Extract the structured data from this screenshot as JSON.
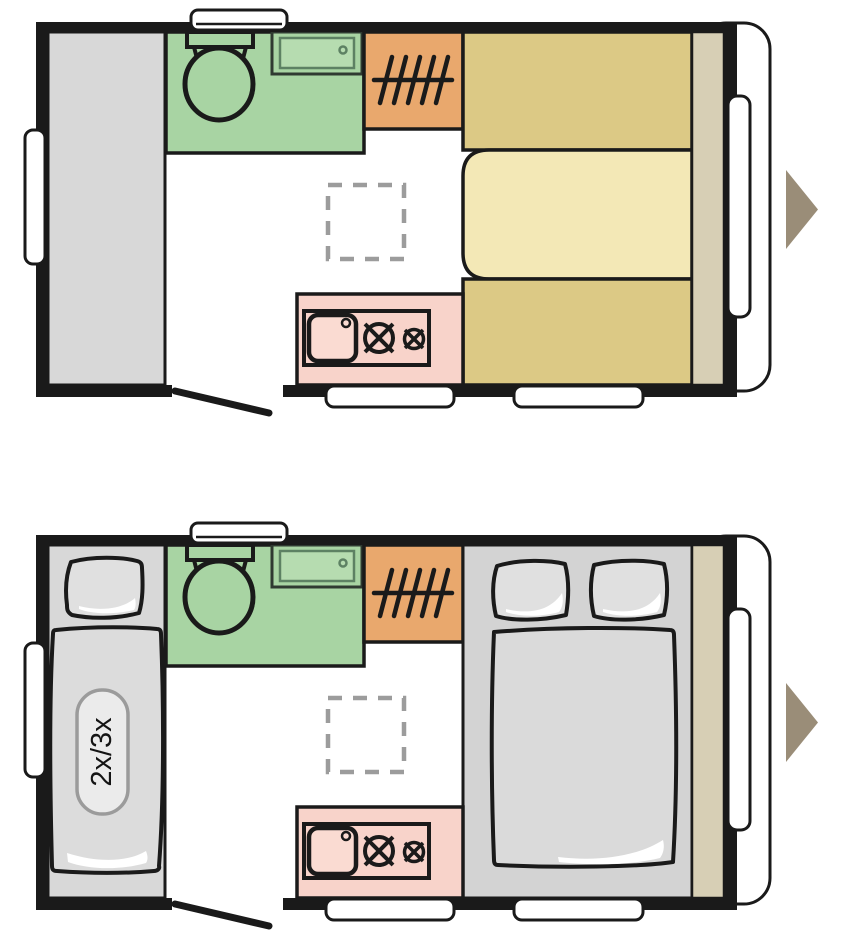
{
  "document": {
    "type": "caravan-floorplan-diagram",
    "views": [
      {
        "id": "day",
        "name": "day layout"
      },
      {
        "id": "night",
        "name": "night layout"
      }
    ]
  },
  "night": {
    "bed_capacity_label": "2x/3x"
  },
  "icons": {
    "toilet": "toilet-top-view",
    "washbasin": "washbasin-top-view",
    "wardrobe": "clothes-rail-with-hangers",
    "kitchen": "sink-with-two-burner-hob",
    "table": "dashed-table-outline",
    "door": "door-swing-line",
    "arrow": "direction-arrow-right"
  },
  "colors": {
    "wall": "#1a1a1a",
    "outline": "#1a1a1a",
    "bathroom_green": "#a8d4a3",
    "basin_inner_green": "#b6dcb0",
    "basin_border_green": "#5d8163",
    "wardrobe_orange": "#e9a86d",
    "seat_tan": "#dcc985",
    "table_cream": "#f3e8b6",
    "shelf_beige": "#d7cfb5",
    "kitchen_pink": "#f8d3ca",
    "kitchen_sink_pink": "#fadbd2",
    "furniture_gray": "#d8d8d8",
    "bed_gray": "#dcdcdc",
    "bed_zone_gray": "#d3d3d3",
    "mattress_gray": "#dadada",
    "pillow_gray": "#e0e0e0",
    "badge_fill": "#ebebeb",
    "badge_border": "#9b9b9b",
    "arrow_taupe": "#9a8d78",
    "table_dashed_gray": "#9c9c9c",
    "window_white": "#ffffff"
  }
}
